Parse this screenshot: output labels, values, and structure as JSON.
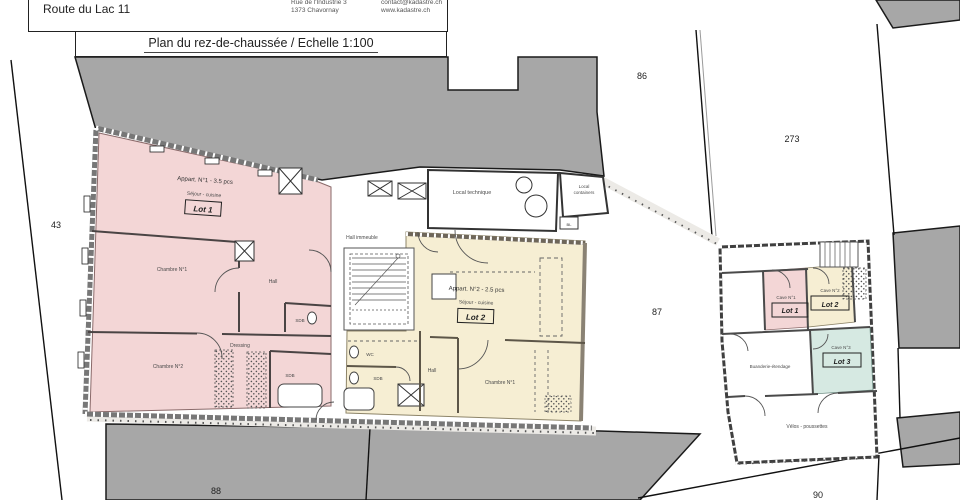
{
  "header": {
    "parcel_line1": "Parcelle 87",
    "parcel_line2": "Route du Lac 11",
    "company": "KADASTRE.CH",
    "address1": "Rue de l'Industrie 3",
    "address2": "1373 Chavornay",
    "phone": "024 510 38 00",
    "email": "contact@kadastre.ch",
    "website": "www.kadastre.ch",
    "title": "Plan du rez-de-chaussée / Echelle 1:100"
  },
  "parcels": {
    "p43": "43",
    "p86": "86",
    "p273": "273",
    "p87": "87",
    "p88": "88",
    "p90": "90"
  },
  "apartment1": {
    "name": "Appart. N°1 - 3.5 pcs",
    "type": "Séjour - cuisine",
    "lot": "Lot 1",
    "chambre1": "Chambre N°1",
    "chambre2": "Chambre N°2",
    "hall": "Hall",
    "dressing": "Dressing",
    "sdb_a": "SDB",
    "sdb_b": "SDB"
  },
  "apartment2": {
    "name": "Appart. N°2 - 2.5 pcs",
    "type": "Séjour - cuisine",
    "lot": "Lot 2",
    "wc": "WC",
    "sdb": "SDB",
    "hall": "Hall",
    "chambre1": "Chambre N°1"
  },
  "common": {
    "hall_immeuble": "Hall immeuble",
    "local_technique": "Local technique",
    "local_containers_1": "Local",
    "local_containers_2": "containers",
    "bl": "BL"
  },
  "annex": {
    "cave1": "Cave N°1",
    "cave1_lot": "Lot 1",
    "cave2": "Cave N°2",
    "cave2_lot": "Lot 2",
    "cave3": "Cave N°3",
    "cave3_lot": "Lot 3",
    "buanderie": "Buanderie-étendage",
    "velos": "Vélos - poussettes"
  },
  "colors": {
    "lot1_pink": "#f3d6d6",
    "lot2_yellow": "#f6eed3",
    "lot3_teal": "#d6e9e2",
    "parcel_gray": "#a7a7a7",
    "wall_dark": "#3f3f3f"
  }
}
